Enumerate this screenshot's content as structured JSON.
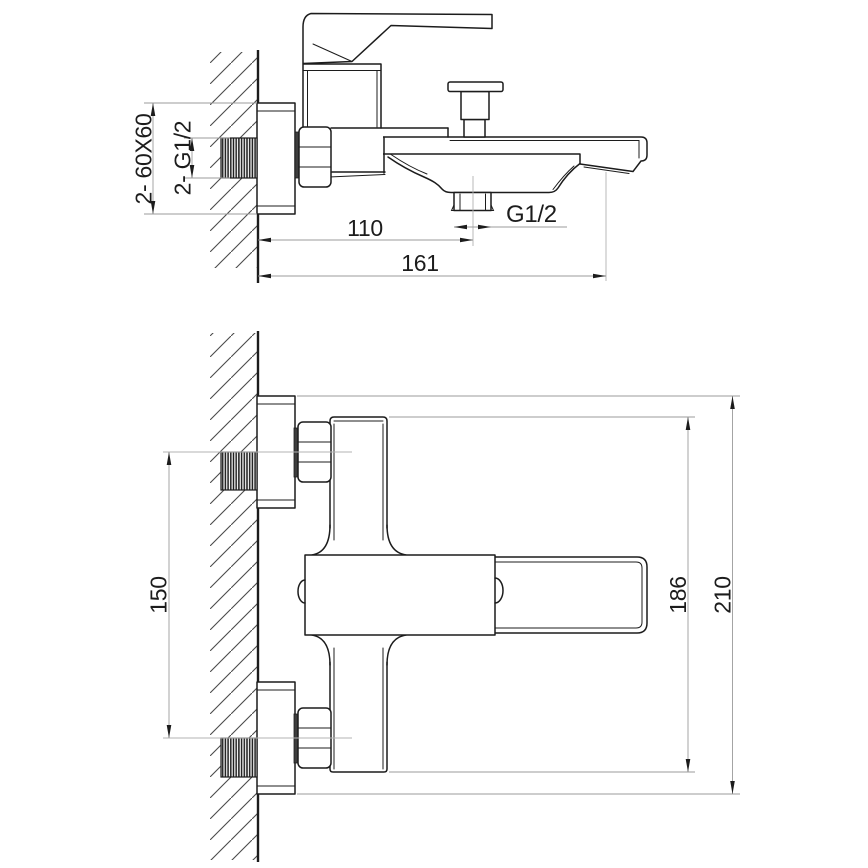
{
  "drawing_type": "faucet installation dimension drawing",
  "colors": {
    "outline": "#1c1c1c",
    "dimension_lines": "#9b9b9b",
    "centerlines": "#b3b3b3",
    "text": "#1c1c1c",
    "background": "#ffffff"
  },
  "side_view": {
    "wall_thread_label": "2- 60X60",
    "inlet_thread_label": "2- G1/2",
    "outlet_thread_label": "G1/2",
    "dim_wall_to_outlet": "110",
    "dim_wall_to_spout_tip": "161"
  },
  "front_view": {
    "dim_inlet_spacing": "150",
    "dim_body_height": "186",
    "dim_overall_height": "210"
  }
}
